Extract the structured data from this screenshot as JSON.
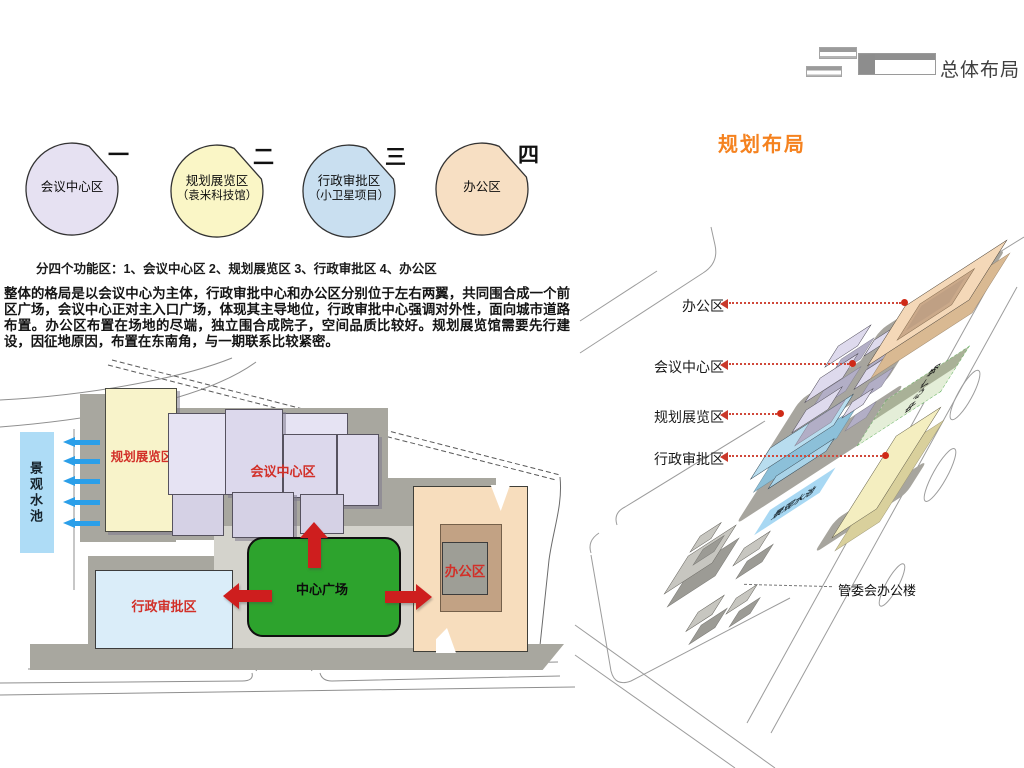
{
  "header": {
    "title": "总体布局"
  },
  "legend": {
    "caption": "分四个功能区：1、会议中心区 2、规划展览区 3、行政审批区 4、办公区",
    "circles": [
      {
        "num": "一",
        "label": "会议中心区",
        "sub": "",
        "color": "#e6e1f2"
      },
      {
        "num": "二",
        "label": "规划展览区",
        "sub": "（袁米科技馆）",
        "color": "#faf6c6"
      },
      {
        "num": "三",
        "label": "行政审批区",
        "sub": "（小卫星项目）",
        "color": "#c9dff0"
      },
      {
        "num": "四",
        "label": "办公区",
        "sub": "",
        "color": "#f7dfc3"
      }
    ]
  },
  "description": "整体的格局是以会议中心为主体，行政审批中心和办公区分别位于左右两翼，共同围合成一个前区广场，会议中心正对主入口广场，体现其主导地位，行政审批中心强调对外性，面向城市道路布置。办公区布置在场地的尽端，独立围合成院子，空间品质比较好。规划展览馆需要先行建设，因征地原因，布置在东南角，与一期联系比较紧密。",
  "site_plan": {
    "labels": {
      "exhibition": "规划展览区",
      "conference": "会议中心区",
      "admin": "行政审批区",
      "office": "办公区",
      "plaza": "中心广场",
      "pool": "景观水池"
    }
  },
  "axon": {
    "title": "规划布局",
    "callouts": [
      {
        "label": "办公区"
      },
      {
        "label": "会议中心区"
      },
      {
        "label": "规划展览区"
      },
      {
        "label": "行政审批区"
      }
    ],
    "plaza_label": "中心广场",
    "pool_label": "景观水池",
    "committee_label": "管委会办公楼"
  },
  "colors": {
    "accent_orange": "#f5821f",
    "red_arrow": "#ce1e1e",
    "blue_arrow": "#2b9fe9",
    "plaza_green": "#2da32d",
    "pool_blue": "#aedcf6",
    "exhibition_yellow": "#f8f3ca",
    "conference_purple": "#e2dff0",
    "admin_blue": "#daedf9",
    "office_orange": "#f7ddbd"
  }
}
